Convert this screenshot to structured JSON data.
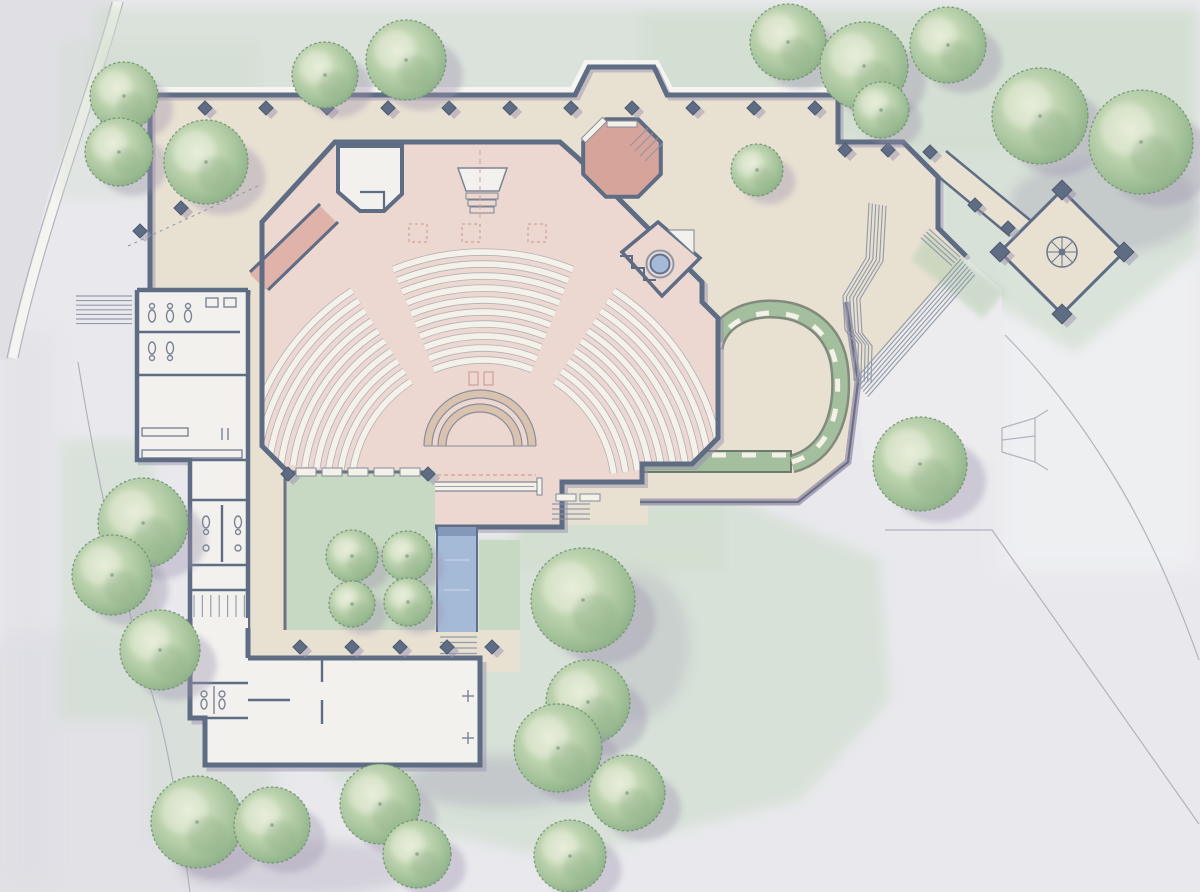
{
  "palette": {
    "paper": "#e9e9ed",
    "paper_bright": "#f1f2f4",
    "paper_shade": "#dcdce3",
    "road": "#e0e0e4",
    "curb_white": "#f5f4f1",
    "pencil": "#a7a9b6",
    "lawn": "#ccdcca",
    "lawn_deep": "#b7cfb2",
    "courtyard_lawn": "#c7d8c3",
    "tree_light": "#e7edda",
    "tree_mid": "#aac5a1",
    "tree_deep": "#86a981",
    "tree_edge": "#6f8f6e",
    "shadow_purple": "#9d94ae",
    "paving": "#e8e1d2",
    "paving_line": "#bfa894",
    "paving_dark": "#d9cab4",
    "pink_floor": "#ecd8d0",
    "pink_line": "#d2a198",
    "pink_dark": "#dfb3a9",
    "pink_deep": "#d6a49b",
    "chancel_floor": "#f2e3dc",
    "room_white": "#f2f1ee",
    "wall": "#5e6c84",
    "wall_light": "#8b9ab0",
    "wall_line": "#4e5a70",
    "wall_shadow": "#968cab",
    "water": "#a5bad7",
    "water_deep": "#7e93b4",
    "water_line": "#60718e",
    "hedge": "#a3bf9e",
    "hedge_dark": "#6f7a6e",
    "bench": "#f4f1e8",
    "stage_band": "#d9c2ae",
    "stair_line": "#8b93a3"
  },
  "scene": {
    "trees": [
      {
        "x": 124,
        "y": 96,
        "r": 34
      },
      {
        "x": 119,
        "y": 152,
        "r": 34
      },
      {
        "x": 206,
        "y": 162,
        "r": 42
      },
      {
        "x": 325,
        "y": 75,
        "r": 33
      },
      {
        "x": 406,
        "y": 60,
        "r": 40
      },
      {
        "x": 757,
        "y": 170,
        "r": 26
      },
      {
        "x": 788,
        "y": 42,
        "r": 38
      },
      {
        "x": 864,
        "y": 66,
        "r": 44
      },
      {
        "x": 881,
        "y": 110,
        "r": 28
      },
      {
        "x": 948,
        "y": 45,
        "r": 38
      },
      {
        "x": 1040,
        "y": 116,
        "r": 48
      },
      {
        "x": 1141,
        "y": 142,
        "r": 52
      },
      {
        "x": 920,
        "y": 464,
        "r": 47
      },
      {
        "x": 352,
        "y": 556,
        "r": 26
      },
      {
        "x": 407,
        "y": 556,
        "r": 25
      },
      {
        "x": 352,
        "y": 604,
        "r": 23
      },
      {
        "x": 408,
        "y": 602,
        "r": 24
      },
      {
        "x": 583,
        "y": 600,
        "r": 52
      },
      {
        "x": 588,
        "y": 702,
        "r": 42
      },
      {
        "x": 558,
        "y": 748,
        "r": 44
      },
      {
        "x": 627,
        "y": 793,
        "r": 38
      },
      {
        "x": 570,
        "y": 856,
        "r": 36
      },
      {
        "x": 143,
        "y": 523,
        "r": 45
      },
      {
        "x": 112,
        "y": 575,
        "r": 40
      },
      {
        "x": 160,
        "y": 650,
        "r": 40
      },
      {
        "x": 197,
        "y": 822,
        "r": 46
      },
      {
        "x": 272,
        "y": 825,
        "r": 38
      },
      {
        "x": 380,
        "y": 804,
        "r": 40
      },
      {
        "x": 417,
        "y": 854,
        "r": 34
      }
    ],
    "piers": [
      {
        "x": 205,
        "y": 108
      },
      {
        "x": 266,
        "y": 108
      },
      {
        "x": 327,
        "y": 108
      },
      {
        "x": 388,
        "y": 108
      },
      {
        "x": 449,
        "y": 108
      },
      {
        "x": 510,
        "y": 108
      },
      {
        "x": 571,
        "y": 108
      },
      {
        "x": 632,
        "y": 108
      },
      {
        "x": 693,
        "y": 108
      },
      {
        "x": 754,
        "y": 108
      },
      {
        "x": 815,
        "y": 108
      },
      {
        "x": 845,
        "y": 150
      },
      {
        "x": 888,
        "y": 150
      },
      {
        "x": 930,
        "y": 152
      },
      {
        "x": 140,
        "y": 231
      },
      {
        "x": 181,
        "y": 208
      },
      {
        "x": 975,
        "y": 205
      },
      {
        "x": 1008,
        "y": 228
      },
      {
        "x": 1062,
        "y": 190,
        "s": 14
      },
      {
        "x": 1124,
        "y": 252,
        "s": 14
      },
      {
        "x": 1062,
        "y": 314,
        "s": 14
      },
      {
        "x": 1000,
        "y": 252,
        "s": 14
      },
      {
        "x": 300,
        "y": 647
      },
      {
        "x": 352,
        "y": 647
      },
      {
        "x": 400,
        "y": 647
      },
      {
        "x": 447,
        "y": 647
      },
      {
        "x": 492,
        "y": 647
      },
      {
        "x": 288,
        "y": 474
      },
      {
        "x": 428,
        "y": 474
      }
    ],
    "pews": {
      "cx": 483,
      "cy": 492,
      "r0": 132,
      "r1": 240,
      "step": 12,
      "sections": [
        {
          "a0": 188,
          "a1": 237
        },
        {
          "a0": 248,
          "a1": 292
        },
        {
          "a0": 303,
          "a1": 352
        }
      ]
    },
    "stage": {
      "cx": 480,
      "cy": 446,
      "bands": [
        [
          48,
          56
        ],
        [
          34,
          42
        ]
      ]
    },
    "stair_runs": [
      {
        "pts": [
          [
            76,
            296
          ],
          [
            132,
            296
          ]
        ],
        "n": 7,
        "ox": 0,
        "oy": 4.6
      },
      {
        "pts": [
          [
            869,
            203
          ],
          [
            866,
            258
          ],
          [
            843,
            296
          ],
          [
            845,
            330
          ],
          [
            855,
            343
          ],
          [
            854,
            380
          ]
        ],
        "n": 6,
        "ox": 3.4,
        "oy": 0.6
      },
      {
        "pts": [
          [
            854,
            381
          ],
          [
            961,
            259
          ]
        ],
        "n": 7,
        "ox": 2.3,
        "oy": 2.6
      },
      {
        "pts": [
          [
            929,
            229
          ],
          [
            960,
            257
          ]
        ],
        "n": 4,
        "ox": -2.7,
        "oy": 2.9
      },
      {
        "pts": [
          [
            440,
            637
          ],
          [
            477,
            637
          ]
        ],
        "n": 4,
        "ox": 0,
        "oy": 5.5
      },
      {
        "pts": [
          [
            552,
            504
          ],
          [
            590,
            504
          ]
        ],
        "n": 4,
        "ox": 0,
        "oy": 5
      },
      {
        "pts": [
          [
            194,
            595
          ],
          [
            194,
            617
          ]
        ],
        "n": 7,
        "ox": 8.4,
        "oy": 0
      },
      {
        "pts": [
          [
            648,
            128
          ],
          [
            630,
            146
          ]
        ],
        "n": 4,
        "ox": 5,
        "oy": 5
      }
    ]
  }
}
